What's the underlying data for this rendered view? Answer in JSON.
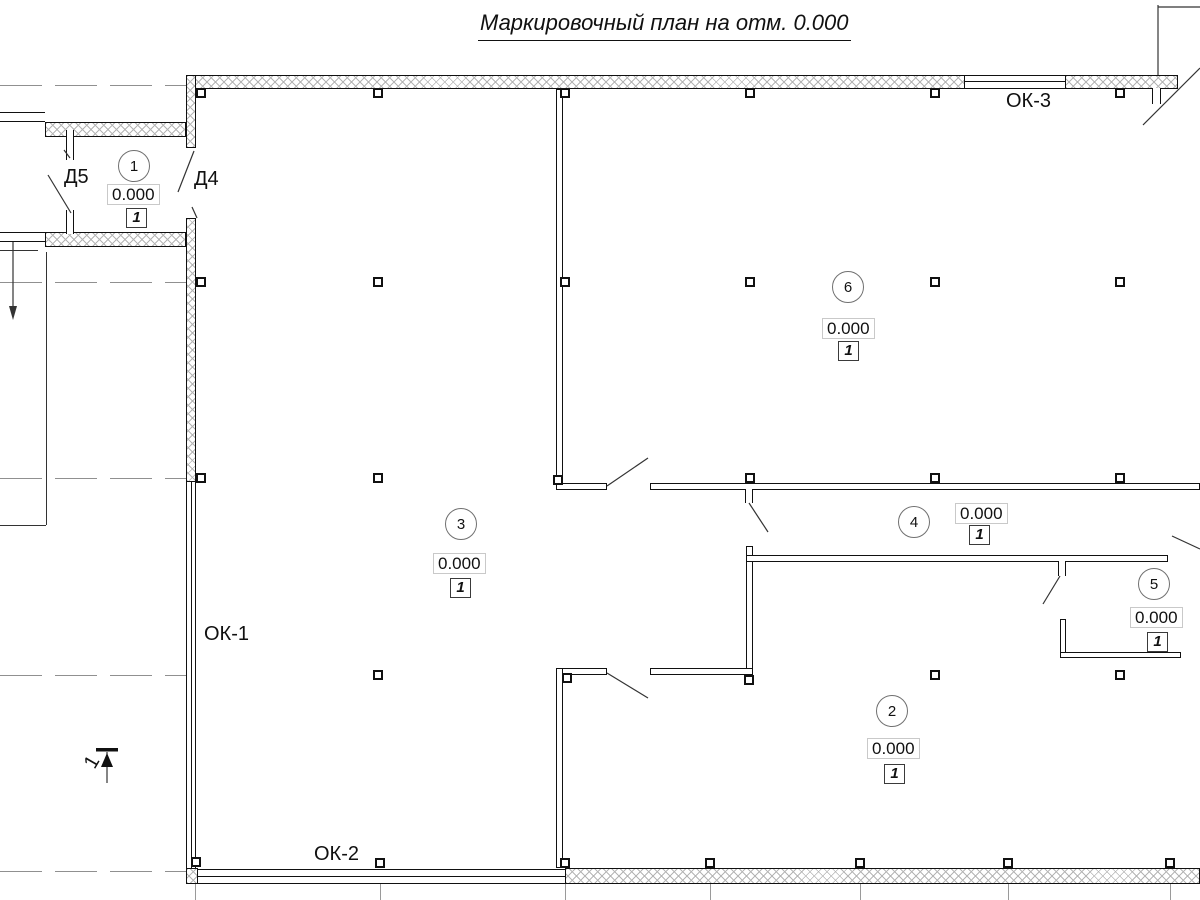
{
  "title": "Маркировочный план на отм. 0.000",
  "rooms": [
    {
      "number": "1",
      "elevation": "0.000",
      "floor_type": "1"
    },
    {
      "number": "2",
      "elevation": "0.000",
      "floor_type": "1"
    },
    {
      "number": "3",
      "elevation": "0.000",
      "floor_type": "1"
    },
    {
      "number": "4",
      "elevation": "0.000",
      "floor_type": "1"
    },
    {
      "number": "5",
      "elevation": "0.000",
      "floor_type": "1"
    },
    {
      "number": "6",
      "elevation": "0.000",
      "floor_type": "1"
    }
  ],
  "door_labels": {
    "d5": "Д5",
    "d4": "Д4"
  },
  "window_labels": {
    "ok1": "ОК-1",
    "ok2": "ОК-2",
    "ok3": "ОК-3"
  },
  "section_mark": {
    "label": "1"
  },
  "colors": {
    "line": "#111111",
    "hatch": "#b5b5b5",
    "axis_line": "#909090",
    "elev_box_border": "#c9c9c9"
  }
}
